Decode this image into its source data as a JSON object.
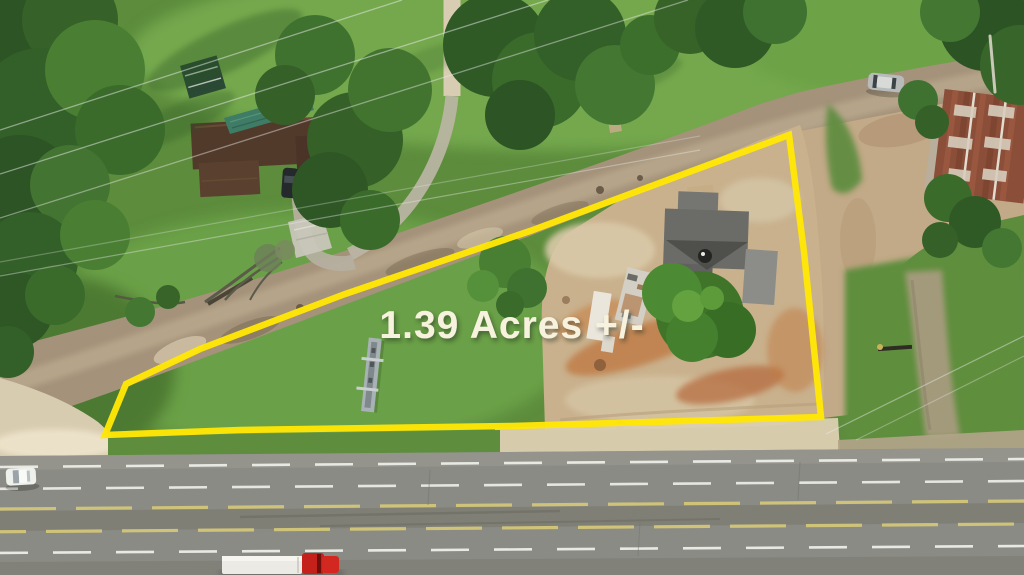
{
  "scene": {
    "overlay": {
      "acreage_label": "1.39 Acres +/-",
      "label_color": "#f7f2dd",
      "boundary_color": "#ffe606",
      "boundary_points": "789,135 804,252 821,417 512,426 240,430 105,435 126,384 200,349 345,294 530,231"
    },
    "objects": {
      "highway": "divided-highway",
      "semi_truck": "red-semi-truck-white-trailer",
      "white_car": "white-car",
      "silver_car": "silver-car-on-gravel-road",
      "left_house": "brown-roof-house-green-awning",
      "shed": "green-shed",
      "barn": "rust-metal-roof-barn",
      "damaged_house": "grey-roof-house-in-cleared-lot",
      "sign_frame": "metal-sign-frame-in-grass",
      "gravel_road": "gravel-road",
      "cleared_lot": "cleared-dirt-lot"
    }
  }
}
